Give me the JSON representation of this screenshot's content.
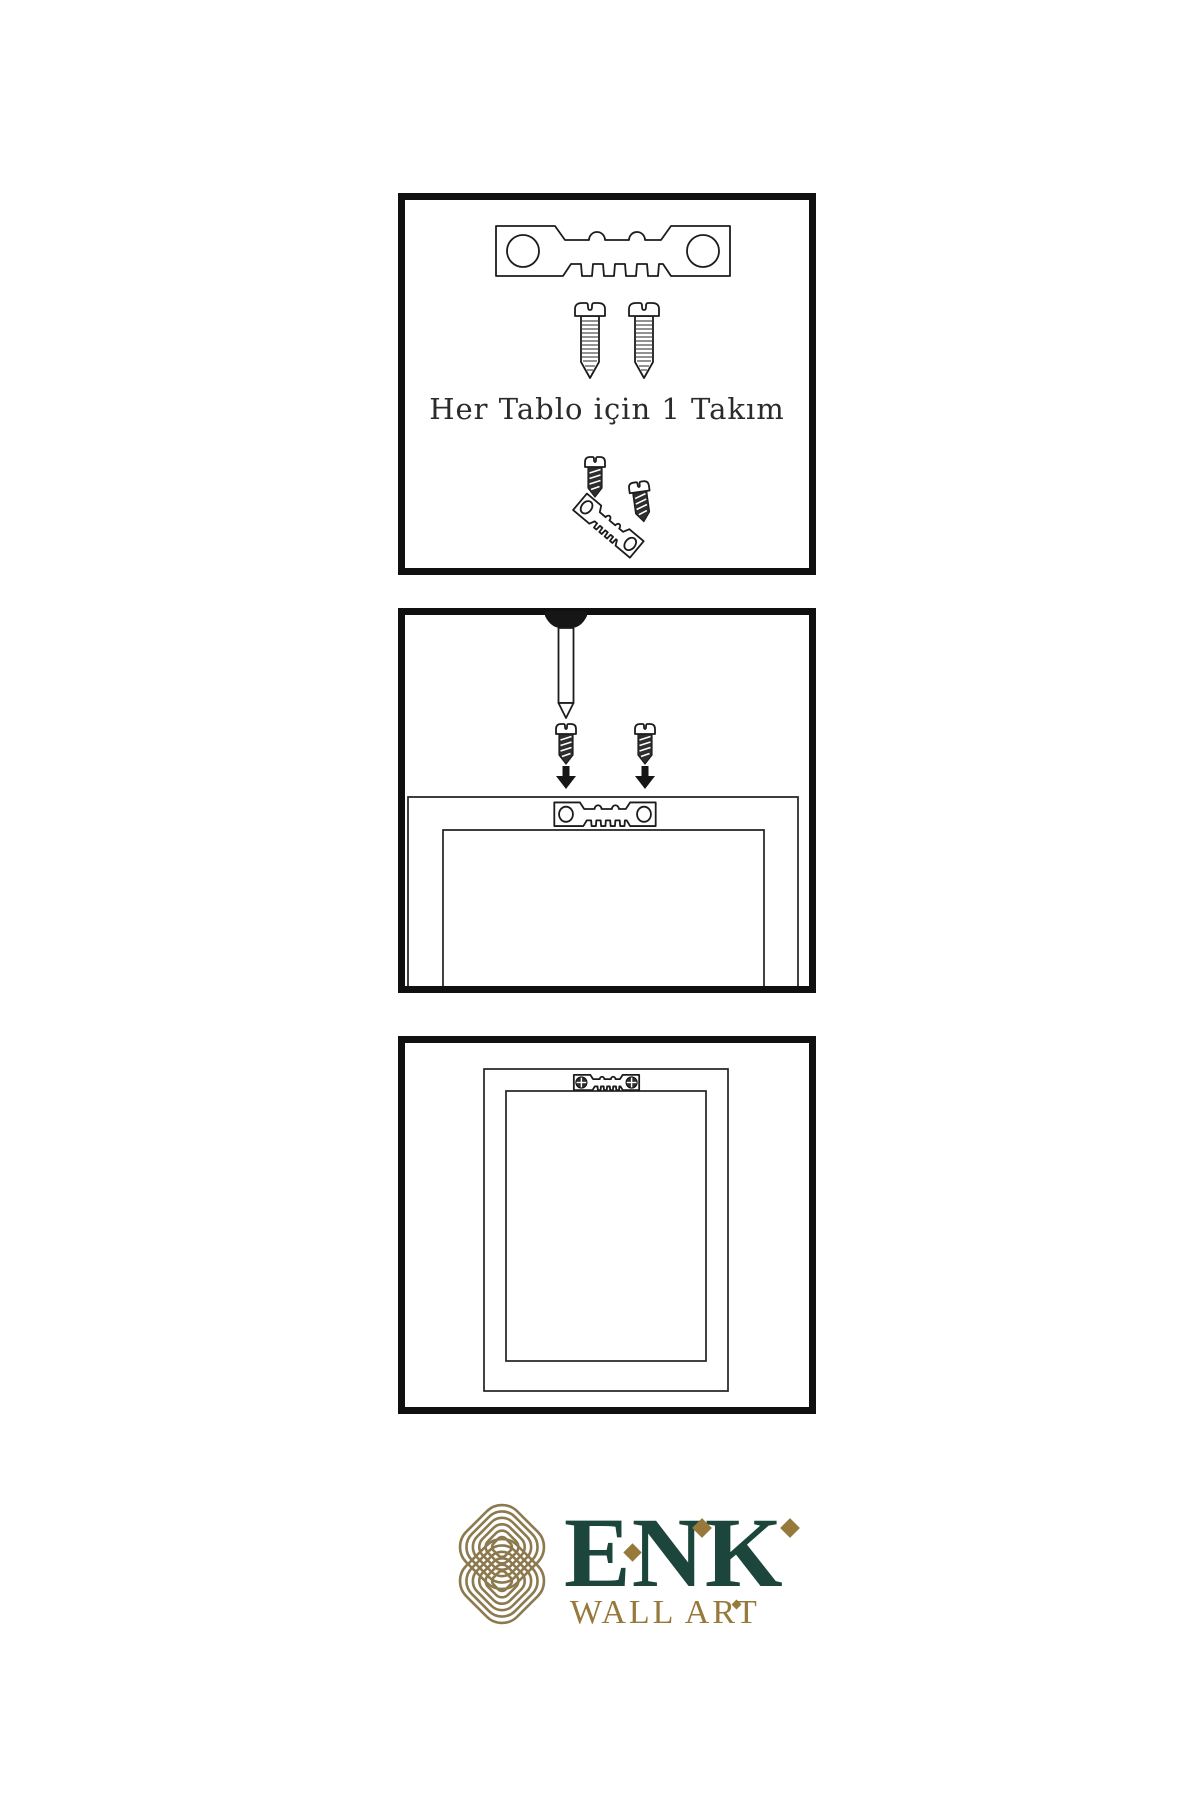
{
  "page": {
    "type": "wall-art-hanging-instructions"
  },
  "panels": [
    {
      "id": "hardware-kit",
      "caption": "Her Tablo için 1 Takım",
      "items": [
        "sawtooth-hanger",
        "screw",
        "screw",
        "screw",
        "tilted-sawtooth-hanger",
        "screw"
      ]
    },
    {
      "id": "installation",
      "items": [
        "wall-nail",
        "dark-screw",
        "dark-screw",
        "down-arrow",
        "down-arrow",
        "frame-back-outline",
        "sawtooth-hanger-mounted"
      ]
    },
    {
      "id": "hung-frame",
      "items": [
        "frame-front-outline",
        "sawtooth-hanger-with-phillips-screws"
      ]
    }
  ],
  "brand": {
    "name": "ENK",
    "tagline": "WALL ART"
  },
  "icons": {
    "hanger": "sawtooth-hanger",
    "screw": "wood-screw",
    "dark_screw": "dark-wood-screw",
    "nail": "wall-nail",
    "arrow": "down-arrow",
    "phillips": "phillips-screw-head",
    "knot": "brand-knot",
    "diamond": "diamond-accent"
  },
  "colors": {
    "line": "#1c1c1c",
    "panel_border": "#101010",
    "background": "#ffffff",
    "logo_green": "#1c463b",
    "logo_gold": "#97793c",
    "knot_gold": "#8c7a4e",
    "hardware_dark": "#2e2e2e"
  }
}
